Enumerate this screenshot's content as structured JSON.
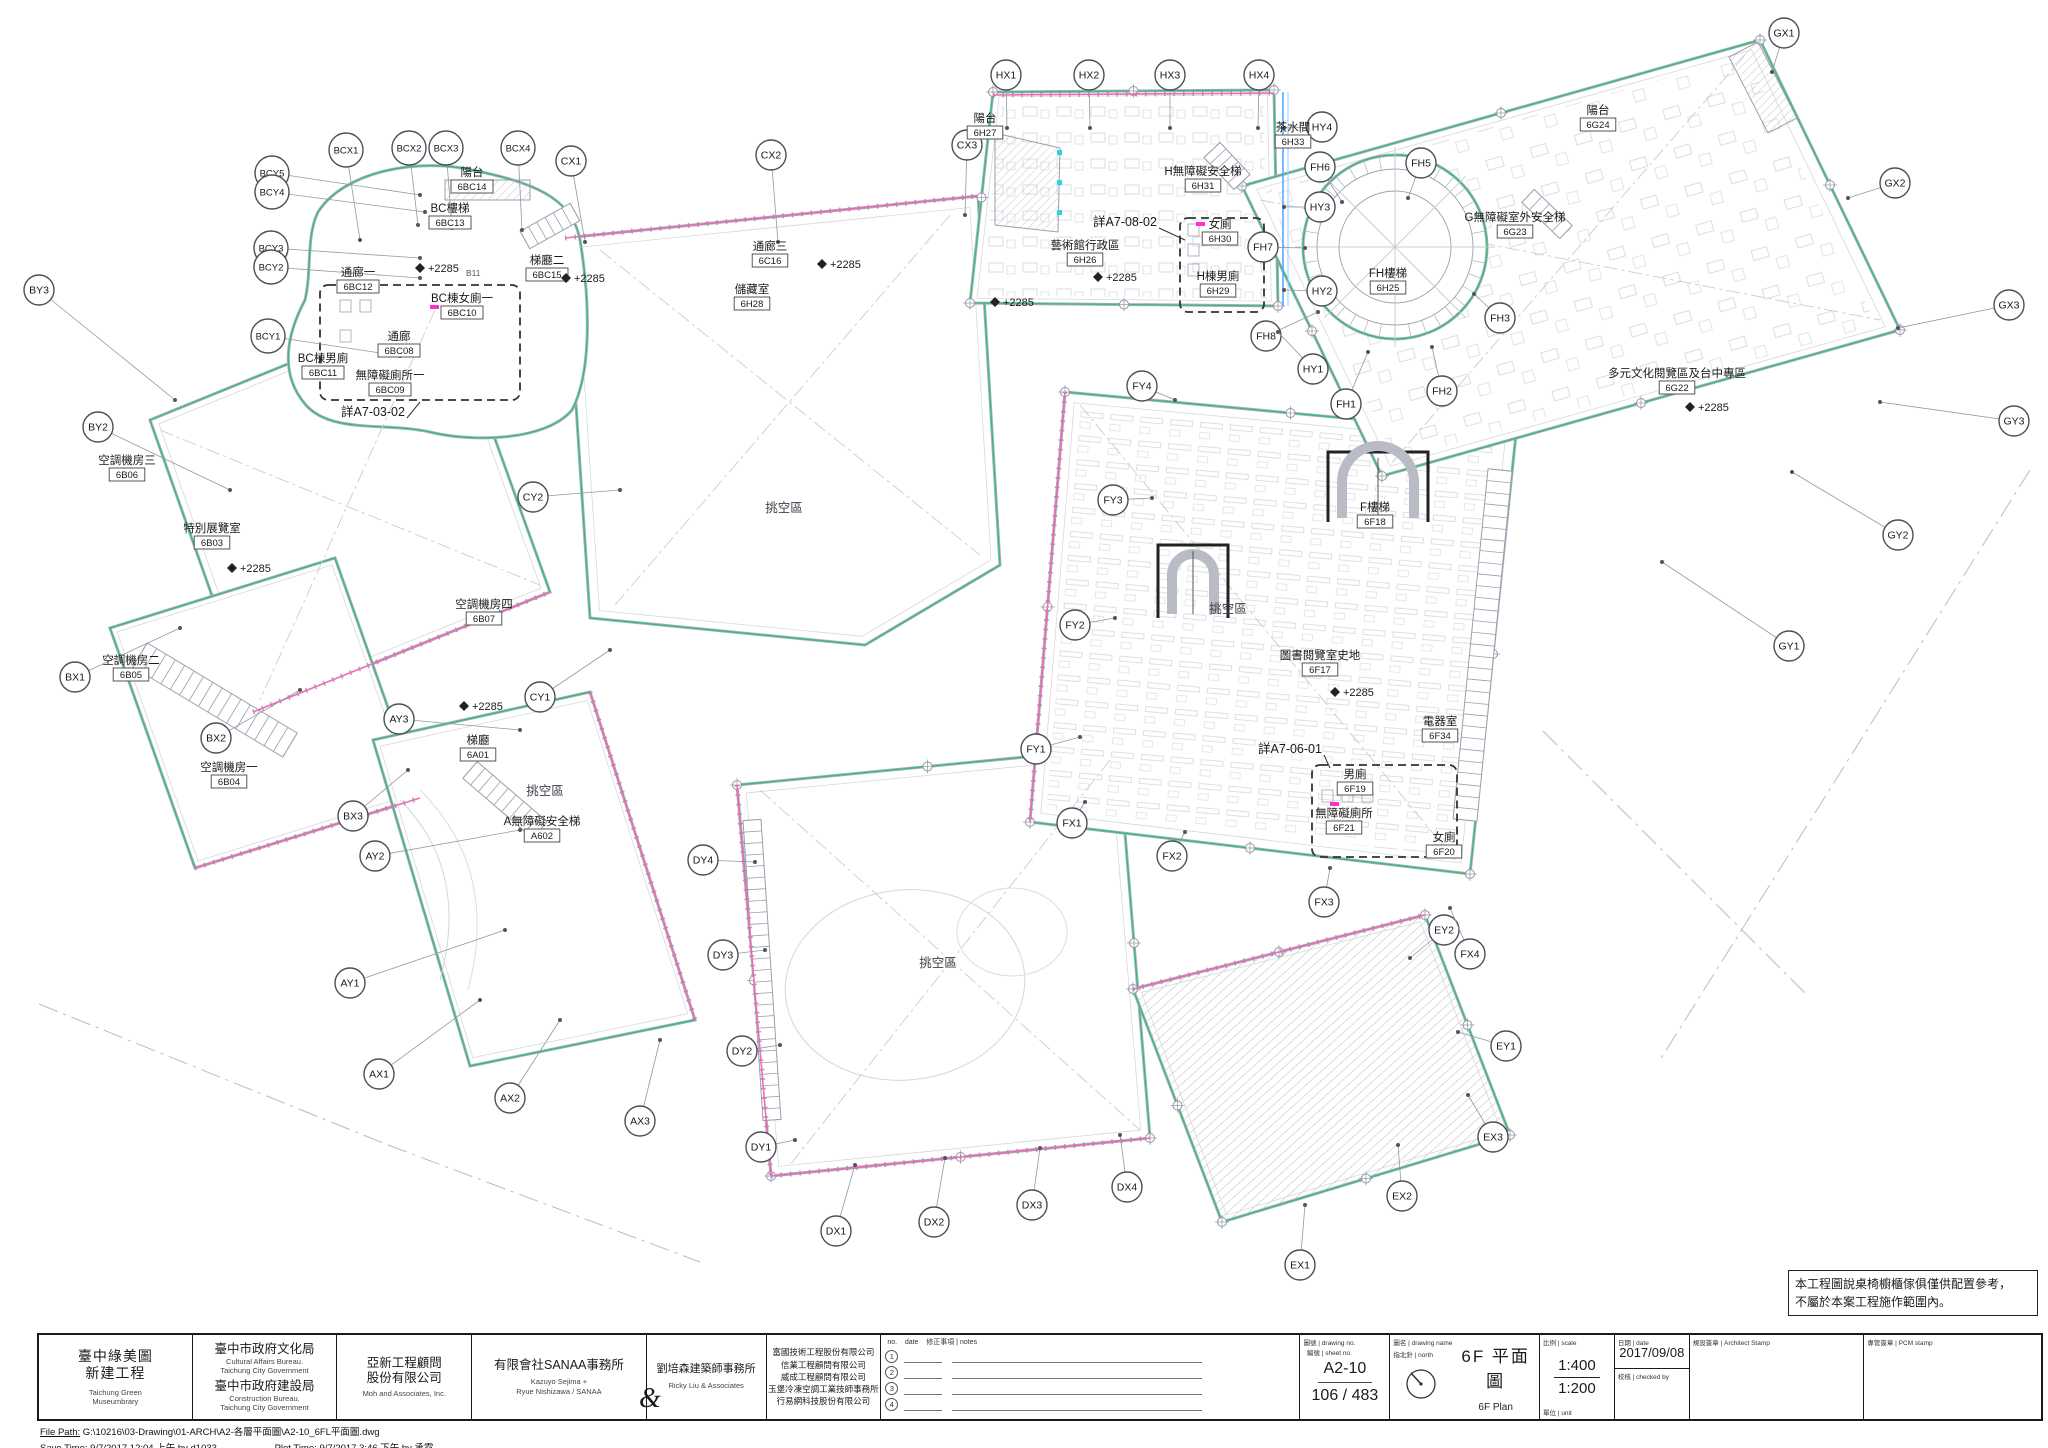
{
  "sheet": {
    "project": {
      "zh1": "臺中綠美圖",
      "zh2": "新建工程",
      "en1": "Taichung Green",
      "en2": "Museumbrary"
    },
    "owner": {
      "zh1": "臺中市政府文化局",
      "en1": "Cultural Affairs Bureau.",
      "en2": "Taichung City Government",
      "zh2": "臺中市政府建設局",
      "en3": "Construction Bureau.",
      "en4": "Taichung City Government"
    },
    "engineer": {
      "zh1": "亞新工程顧問",
      "zh2": "股份有限公司",
      "en": "Moh and Associates, Inc."
    },
    "architect1": {
      "zh": "有限會社SANAA事務所",
      "en1": "Kazuyo Sejima +",
      "en2": "Ryue Nishizawa / SANAA"
    },
    "ampersand": "&",
    "architect2": {
      "zh": "劉培森建築師事務所",
      "en": "Ricky Liu & Associates"
    },
    "consultants": [
      "富國技術工程股份有限公司",
      "信業工程顧問有限公司",
      "威成工程顧問有限公司",
      "玉堡冷凍空調工業技師事務所",
      "行易網科技股份有限公司"
    ],
    "revisions": {
      "no_label": "no.",
      "date_label": "date",
      "notes_label": "修正事項 | notes",
      "rows": [
        "1",
        "2",
        "3",
        "4"
      ]
    },
    "drawing_no_label": "圖號 | drawing no.",
    "sheet_no_label": "編號 | sheet no.",
    "drawing_no": "A2-10",
    "sheet_no": "106 / 483",
    "north_label": "指北針 | north",
    "name_label": "圖名 | drawing name",
    "name_zh": "6F 平面圖",
    "name_en": "6F Plan",
    "scale_label": "比例 | scale",
    "scale_1": "1:400",
    "scale_2": "1:200",
    "unit_label": "單位 | unit",
    "date_label": "日期 | date",
    "date": "2017/09/08",
    "checked_label": "校核 | checked by",
    "stamp1_label": "規設簽章 | Architect Stamp",
    "stamp2_label": "專管簽章 | PCM stamp",
    "file_path_label": "File Path:",
    "file_path": "G:\\10216\\03-Drawing\\01-ARCH\\A2-各層平面圖\\A2-10_6FL平面圖.dwg",
    "save_time_label": "Save Time:",
    "save_time": "9/7/2017 12:04 上午  by d1033",
    "plot_time_label": "Plot Time:",
    "plot_time": "9/7/2017 3:46 下午  by 承霓",
    "note_line1": "本工程圖說桌椅櫥櫃傢俱僅供配置參考，",
    "note_line2": "不屬於本案工程施作範圍內。"
  },
  "plan": {
    "colors": {
      "green": "#2fbf71",
      "pink": "#f06ab8",
      "magenta": "#ff2fd0",
      "cyan": "#27d6e0",
      "gray": "#a9aebc",
      "line": "#8f97a8",
      "text": "#1a1a1a",
      "blue": "#4aa3ff"
    },
    "bubbles": [
      [
        "BCY5",
        272,
        173,
        420,
        195
      ],
      [
        "BCY4",
        272,
        192,
        425,
        212
      ],
      [
        "BCY3",
        271,
        248,
        420,
        258
      ],
      [
        "BCY2",
        271,
        267,
        420,
        278
      ],
      [
        "BCY1",
        268,
        336,
        400,
        356
      ],
      [
        "BCX1",
        346,
        150,
        360,
        240
      ],
      [
        "BCX2",
        409,
        148,
        418,
        225
      ],
      [
        "BCX3",
        446,
        148,
        452,
        228
      ],
      [
        "BCX4",
        518,
        148,
        522,
        230
      ],
      [
        "BY3",
        39,
        290,
        175,
        400
      ],
      [
        "BY2",
        98,
        427,
        230,
        490
      ],
      [
        "BX1",
        75,
        677,
        180,
        628
      ],
      [
        "BX2",
        216,
        738,
        300,
        690
      ],
      [
        "BX3",
        353,
        816,
        408,
        770
      ],
      [
        "CX1",
        571,
        161,
        585,
        242
      ],
      [
        "CX2",
        771,
        155,
        778,
        242
      ],
      [
        "CX3",
        967,
        145,
        965,
        215
      ],
      [
        "CY2",
        533,
        497,
        620,
        490
      ],
      [
        "CY1",
        540,
        697,
        610,
        650
      ],
      [
        "AY3",
        399,
        719,
        520,
        730
      ],
      [
        "AY2",
        375,
        856,
        520,
        830
      ],
      [
        "AY1",
        350,
        983,
        505,
        930
      ],
      [
        "AX1",
        379,
        1074,
        480,
        1000
      ],
      [
        "AX2",
        510,
        1098,
        560,
        1020
      ],
      [
        "AX3",
        640,
        1121,
        660,
        1040
      ],
      [
        "DY4",
        703,
        860,
        755,
        862
      ],
      [
        "DY3",
        723,
        955,
        765,
        950
      ],
      [
        "DY2",
        742,
        1051,
        780,
        1045
      ],
      [
        "DY1",
        761,
        1147,
        795,
        1140
      ],
      [
        "DX1",
        836,
        1231,
        855,
        1165
      ],
      [
        "DX2",
        934,
        1222,
        945,
        1158
      ],
      [
        "DX3",
        1032,
        1205,
        1040,
        1148
      ],
      [
        "DX4",
        1127,
        1187,
        1120,
        1135
      ],
      [
        "EX1",
        1300,
        1265,
        1305,
        1205
      ],
      [
        "EX2",
        1402,
        1196,
        1398,
        1145
      ],
      [
        "EX3",
        1493,
        1137,
        1468,
        1095
      ],
      [
        "EY1",
        1506,
        1046,
        1458,
        1032
      ],
      [
        "EY2",
        1444,
        930,
        1410,
        958
      ],
      [
        "FX1",
        1072,
        823,
        1085,
        802
      ],
      [
        "FX2",
        1172,
        856,
        1185,
        832
      ],
      [
        "FX3",
        1324,
        902,
        1330,
        868
      ],
      [
        "FX4",
        1470,
        954,
        1450,
        908
      ],
      [
        "FY1",
        1036,
        749,
        1080,
        737
      ],
      [
        "FY2",
        1075,
        625,
        1115,
        618
      ],
      [
        "FY3",
        1113,
        500,
        1152,
        498
      ],
      [
        "FY4",
        1142,
        386,
        1175,
        400
      ],
      [
        "FH1",
        1346,
        404,
        1368,
        352
      ],
      [
        "FH2",
        1442,
        391,
        1432,
        347
      ],
      [
        "FH3",
        1500,
        318,
        1474,
        294
      ],
      [
        "FH5",
        1421,
        163,
        1408,
        198
      ],
      [
        "FH6",
        1320,
        167,
        1342,
        202
      ],
      [
        "FH7",
        1263,
        247,
        1305,
        248
      ],
      [
        "FH8",
        1266,
        336,
        1318,
        312
      ],
      [
        "HY4",
        1322,
        127,
        1284,
        128
      ],
      [
        "HY3",
        1320,
        207,
        1284,
        207
      ],
      [
        "HY2",
        1322,
        291,
        1284,
        290
      ],
      [
        "HY1",
        1313,
        369,
        1278,
        332
      ],
      [
        "HX1",
        1006,
        75,
        1007,
        128
      ],
      [
        "HX2",
        1089,
        75,
        1090,
        128
      ],
      [
        "HX3",
        1170,
        75,
        1170,
        128
      ],
      [
        "HX4",
        1259,
        75,
        1258,
        128
      ],
      [
        "GX1",
        1784,
        33,
        1772,
        72
      ],
      [
        "GX2",
        1895,
        183,
        1848,
        198
      ],
      [
        "GX3",
        2009,
        305,
        1898,
        328
      ],
      [
        "GY3",
        2014,
        421,
        1880,
        402
      ],
      [
        "GY2",
        1898,
        535,
        1792,
        472
      ],
      [
        "GY1",
        1789,
        646,
        1662,
        562
      ]
    ],
    "rooms": [
      {
        "n": "空調機房三",
        "c": "6B06",
        "x": 127,
        "y": 464
      },
      {
        "n": "特別展覽室",
        "c": "6B03",
        "x": 212,
        "y": 532
      },
      {
        "n": "空調機房四",
        "c": "6B07",
        "x": 484,
        "y": 608
      },
      {
        "n": "空調機房二",
        "c": "6B05",
        "x": 131,
        "y": 664
      },
      {
        "n": "空調機房一",
        "c": "6B04",
        "x": 229,
        "y": 771
      },
      {
        "n": "陽台",
        "c": "6BC14",
        "x": 472,
        "y": 176
      },
      {
        "n": "BC樓梯",
        "c": "6BC13",
        "x": 450,
        "y": 212
      },
      {
        "n": "梯廳二",
        "c": "6BC15",
        "x": 547,
        "y": 264
      },
      {
        "n": "通廊一",
        "c": "6BC12",
        "x": 358,
        "y": 276
      },
      {
        "n": "BC棟女廁一",
        "c": "6BC10",
        "x": 462,
        "y": 302
      },
      {
        "n": "BC棟男廁",
        "c": "6BC11",
        "x": 323,
        "y": 362
      },
      {
        "n": "通廊",
        "c": "6BC08",
        "x": 399,
        "y": 340
      },
      {
        "n": "無障礙廁所一",
        "c": "6BC09",
        "x": 390,
        "y": 379
      },
      {
        "n": "通廊三",
        "c": "6C16",
        "x": 770,
        "y": 250
      },
      {
        "n": "儲藏室",
        "c": "6H28",
        "x": 752,
        "y": 293
      },
      {
        "n": "陽台",
        "c": "6H27",
        "x": 985,
        "y": 122
      },
      {
        "n": "H無障礙安全梯",
        "c": "6H31",
        "x": 1203,
        "y": 175
      },
      {
        "n": "藝術館行政區",
        "c": "6H26",
        "x": 1085,
        "y": 249
      },
      {
        "n": "女廁",
        "c": "6H30",
        "x": 1220,
        "y": 228
      },
      {
        "n": "H棟男廁",
        "c": "6H29",
        "x": 1218,
        "y": 280
      },
      {
        "n": "茶水間",
        "c": "6H33",
        "x": 1293,
        "y": 131
      },
      {
        "n": "FH樓梯",
        "c": "6H25",
        "x": 1388,
        "y": 277
      },
      {
        "n": "陽台",
        "c": "6G24",
        "x": 1598,
        "y": 114
      },
      {
        "n": "G無障礙室外安全梯",
        "c": "6G23",
        "x": 1515,
        "y": 221
      },
      {
        "n": "多元文化閱覽區及台中專區",
        "c": "6G22",
        "x": 1677,
        "y": 377
      },
      {
        "n": "F樓梯",
        "c": "6F18",
        "x": 1375,
        "y": 511
      },
      {
        "n": "圖書閱覽室史地",
        "c": "6F17",
        "x": 1320,
        "y": 659
      },
      {
        "n": "電器室",
        "c": "6F34",
        "x": 1440,
        "y": 725
      },
      {
        "n": "男廁",
        "c": "6F19",
        "x": 1355,
        "y": 778
      },
      {
        "n": "無障礙廁所",
        "c": "6F21",
        "x": 1344,
        "y": 817
      },
      {
        "n": "女廁",
        "c": "6F20",
        "x": 1444,
        "y": 841
      },
      {
        "n": "梯廳",
        "c": "6A01",
        "x": 478,
        "y": 744
      },
      {
        "n": "A無障礙安全梯",
        "c": "A602",
        "x": 542,
        "y": 825
      }
    ],
    "voids": [
      {
        "t": "挑空區",
        "x": 784,
        "y": 512
      },
      {
        "t": "挑空區",
        "x": 545,
        "y": 795
      },
      {
        "t": "挑空區",
        "x": 938,
        "y": 967
      },
      {
        "t": "挑空區",
        "x": 1228,
        "y": 613
      }
    ],
    "details": [
      {
        "t": "詳A7-08-02",
        "x": 1125,
        "y": 226,
        "lx": 1185,
        "ly": 240
      },
      {
        "t": "詳A7-03-02",
        "x": 373,
        "y": 416,
        "lx": 420,
        "ly": 402
      },
      {
        "t": "詳A7-06-01",
        "x": 1290,
        "y": 753,
        "lx": 1330,
        "ly": 768
      }
    ],
    "elev_text": "+2285",
    "elevs": [
      {
        "x": 232,
        "y": 568
      },
      {
        "x": 420,
        "y": 268
      },
      {
        "x": 566,
        "y": 278
      },
      {
        "x": 822,
        "y": 264
      },
      {
        "x": 1098,
        "y": 277
      },
      {
        "x": 995,
        "y": 302
      },
      {
        "x": 464,
        "y": 706
      },
      {
        "x": 1335,
        "y": 692
      },
      {
        "x": 1690,
        "y": 407
      }
    ],
    "small_texts": [
      {
        "t": "B11",
        "x": 466,
        "y": 276
      }
    ]
  }
}
